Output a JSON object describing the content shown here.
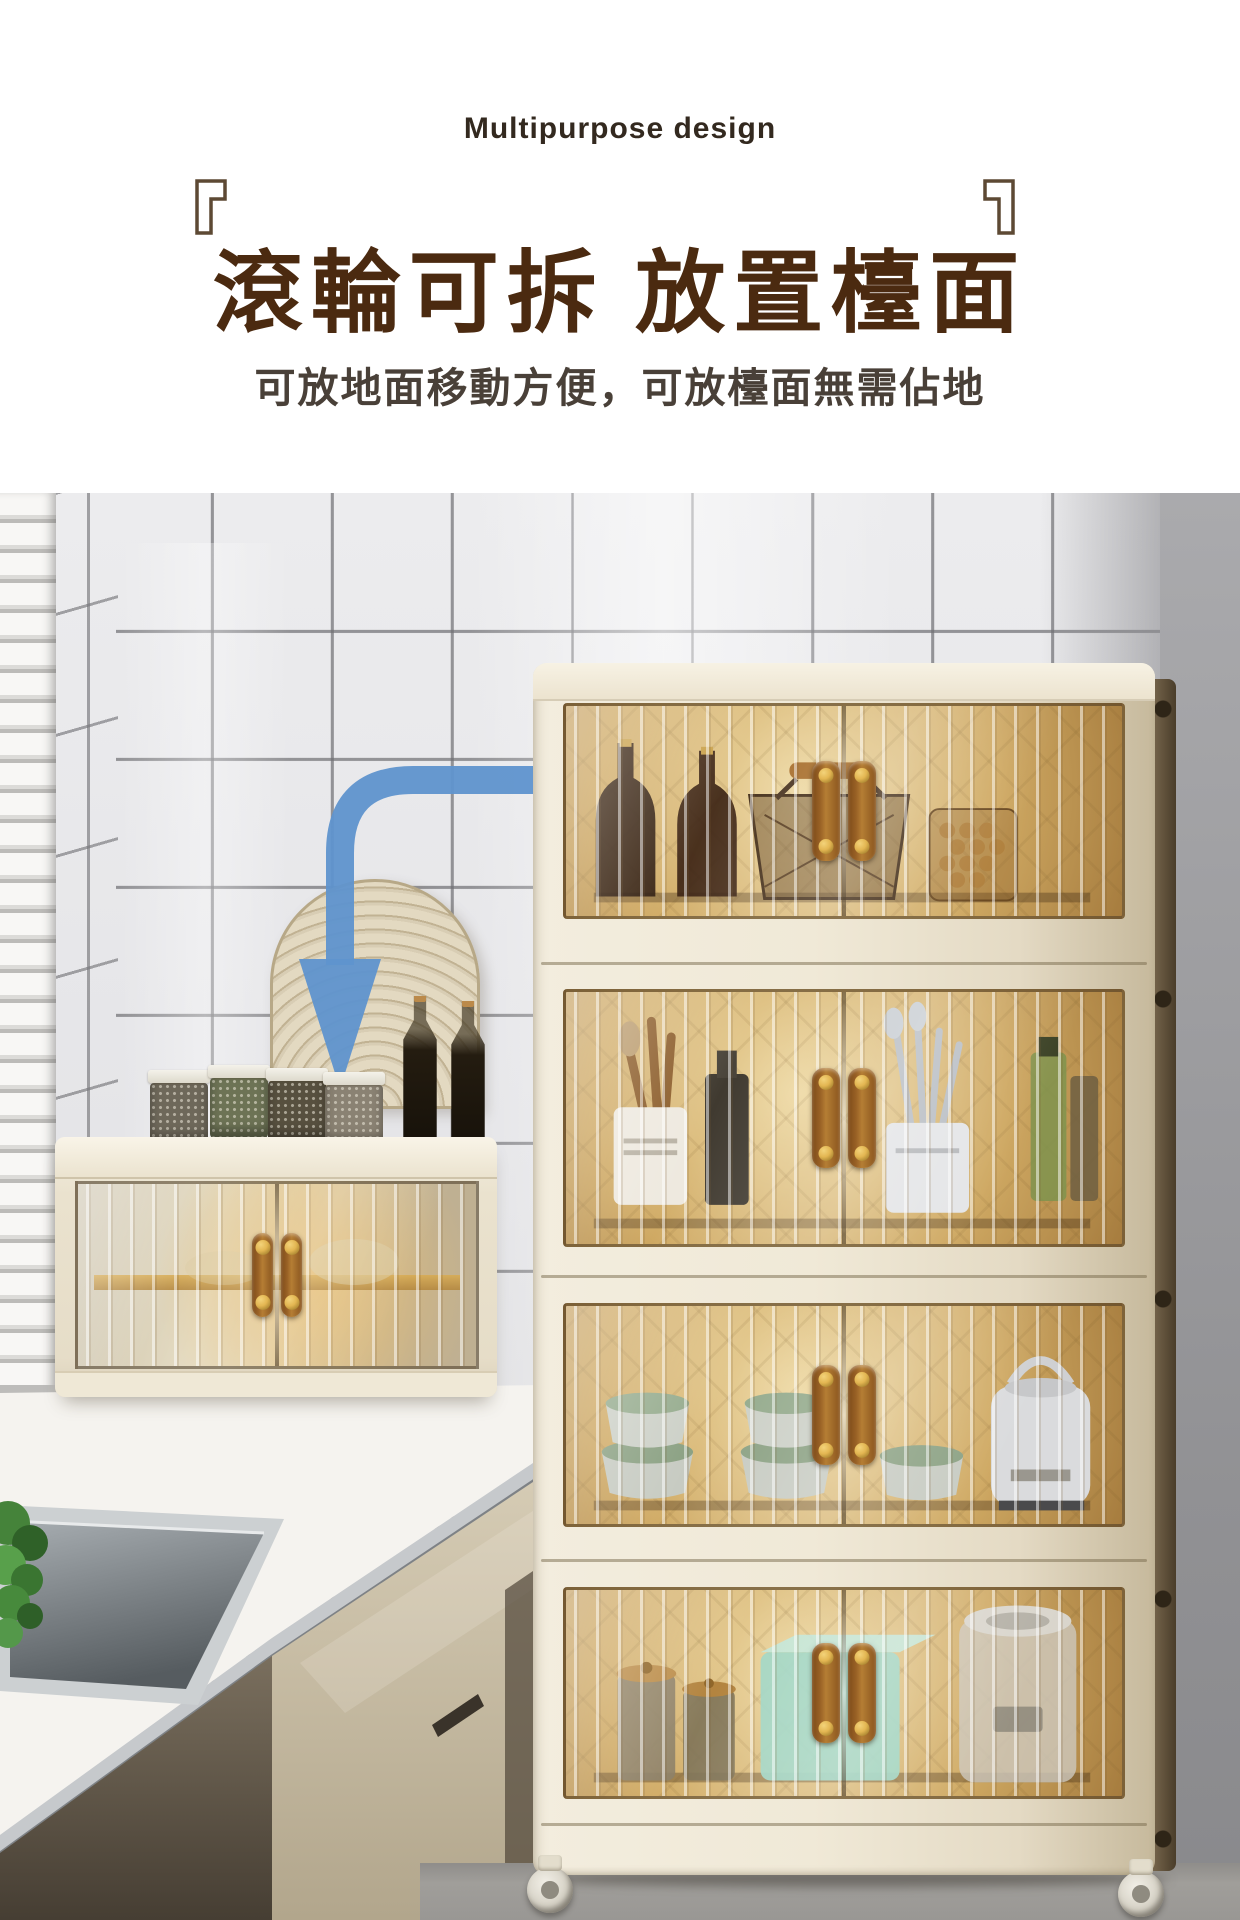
{
  "header": {
    "eyebrow": "Multipurpose design",
    "bracket_open": "『",
    "bracket_close": "』",
    "title": "滾輪可拆 放置檯面",
    "subtitle": "可放地面移動方便，可放檯面無需佔地"
  },
  "palette": {
    "eyebrow-brown": "#33291f",
    "title-brown": "#4b2a10",
    "subtitle-gray": "#494038",
    "bracket-brown": "#5d4934",
    "arrow-blue": "#5f93cd",
    "frame-cream": "#f0e9d7",
    "glass-amber": "#cfa963",
    "glass-amber-light": "#eed9a4",
    "glass-amber-dark": "#a67c3e",
    "handle-brown": "#9a6226",
    "handle-gold": "#e3b652",
    "wall-gray": "#919194",
    "counter-white": "#f5f3ef",
    "drawer-beige": "#cbbfa6",
    "teal-box": "#a2d5c3",
    "floor-gray": "#a09e9a",
    "plant-green": "#478a3c",
    "arch-tan": "#d8cdb4",
    "sink-steel": "#aeb3b7"
  },
  "scene": {
    "objects": [
      "white tiled kitchen wall",
      "window blinds",
      "blue arrow from cabinet to countertop unit",
      "rattan arch decor",
      "spice jars and oil bottles on countertop box",
      "single-tier folding storage box on countertop",
      "four-tier folding storage cabinet with amber doors and wheels",
      "kitchen counter with sink and green plant",
      "beige lower cabinet drawer front"
    ]
  }
}
